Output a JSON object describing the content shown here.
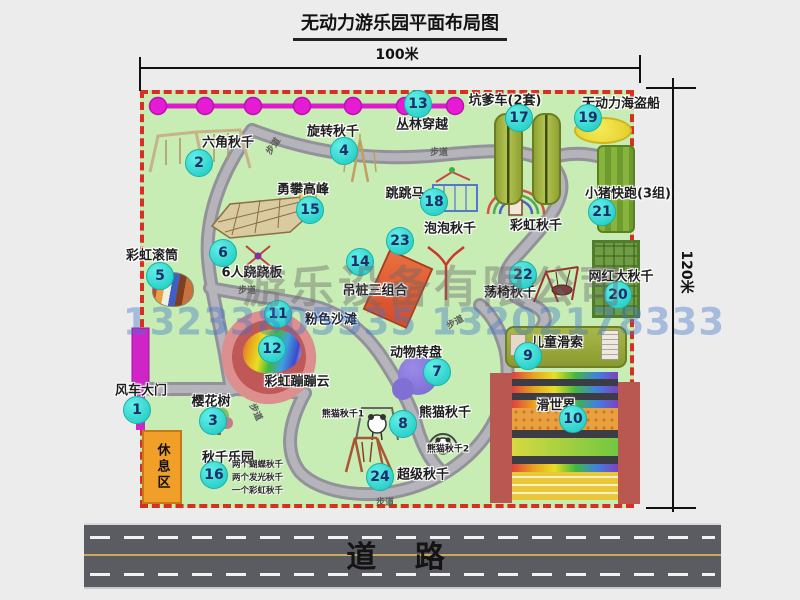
{
  "title": "无动力游乐园平面布局图",
  "dimensions": {
    "width_label": "100米",
    "height_label": "120米"
  },
  "road_label": "道  路",
  "walkway_label": "步道",
  "rest_area_label": "休息区",
  "watermark": {
    "line1": "游乐设备有限公司",
    "line2": "13233805535 13202178333"
  },
  "items": [
    {
      "num": "1",
      "label": "风车大门"
    },
    {
      "num": "2",
      "label": "六角秋千"
    },
    {
      "num": "3",
      "label": "樱花树"
    },
    {
      "num": "4",
      "label": "旋转秋千"
    },
    {
      "num": "5",
      "label": "彩虹滚筒"
    },
    {
      "num": "6",
      "label": "6人跷跷板"
    },
    {
      "num": "7",
      "label": "动物转盘"
    },
    {
      "num": "8",
      "label": "熊猫秋千",
      "sub1": "熊猫秋千1",
      "sub2": "熊猫秋千2"
    },
    {
      "num": "9",
      "label": "儿童滑索"
    },
    {
      "num": "10",
      "label": "滑世界"
    },
    {
      "num": "11",
      "label": "粉色沙滩"
    },
    {
      "num": "12",
      "label": "彩虹蹦蹦云"
    },
    {
      "num": "13",
      "label": "丛林穿越"
    },
    {
      "num": "14",
      "label": "吊桩三组合"
    },
    {
      "num": "15",
      "label": "勇攀高峰"
    },
    {
      "num": "16",
      "label": "秋千乐园",
      "notes": [
        "两个蝴蝶秋千",
        "两个发光秋千",
        "一个彩虹秋千"
      ]
    },
    {
      "num": "17",
      "label": "坑爹车(2套)"
    },
    {
      "num": "18",
      "label": "跳跳马"
    },
    {
      "num": "19",
      "label": "无动力海盗船"
    },
    {
      "num": "20",
      "label": "网红大秋千"
    },
    {
      "num": "21",
      "label": "小猪快跑(3组)"
    },
    {
      "num": "22",
      "label": "荡椅秋千"
    },
    {
      "num": "23",
      "label": "泡泡秋千"
    },
    {
      "num": "24",
      "label": "超级秋千"
    },
    {
      "num": "",
      "label": "彩虹秋千"
    }
  ],
  "colors": {
    "park_green": "#c7ecb4",
    "border_red": "#d83020",
    "badge_cyan": "#2dd2cb",
    "badge_text": "#1c2f68",
    "chain_magenta": "#e018d0",
    "path_gray": "#a8a7ad",
    "road_gray": "#5b5b62",
    "gate_magenta": "#cf25c8",
    "rest_orange": "#f0a028"
  }
}
